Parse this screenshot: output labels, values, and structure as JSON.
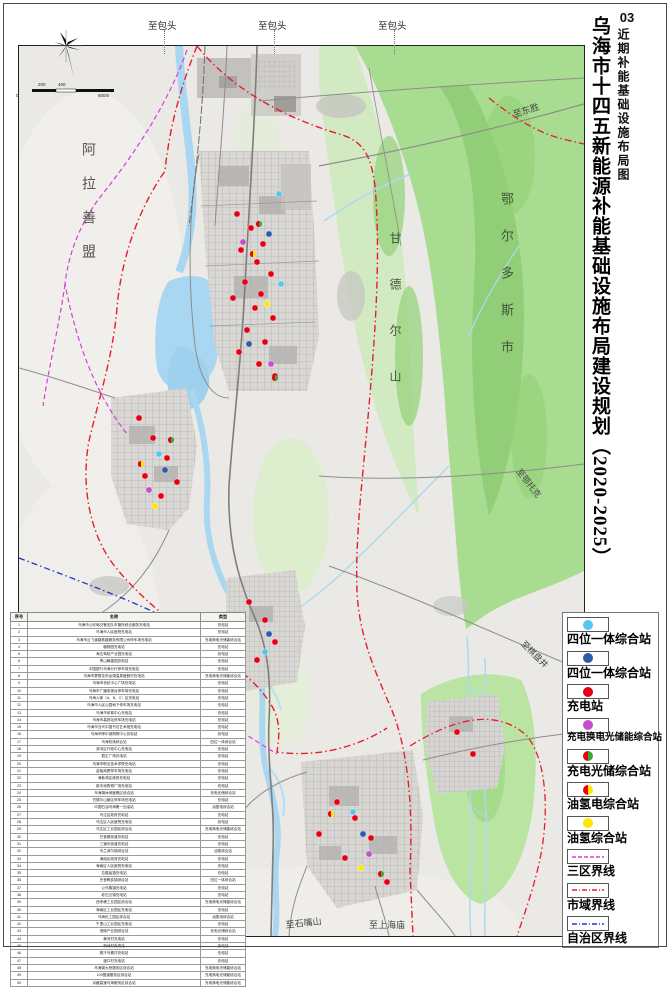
{
  "title": {
    "number": "03",
    "sheet": "近期补能基础设施布局图",
    "main": "乌海市十四五新能源补能基础设施布局建设规划（2020-2025）"
  },
  "colors": {
    "cyan": "#54c6f0",
    "blue": "#2a5caa",
    "red": "#e60012",
    "magenta": "#c44fc8",
    "green": "#3aaa35",
    "yellow": "#ffe600",
    "boundary_city": "#e81c2e",
    "boundary_zone": "#d93ed9",
    "boundary_region": "#2233cc",
    "terrain_green": "#a8dc90",
    "water": "#a9d7f2"
  },
  "legend": {
    "items": [
      {
        "symbol": "dot",
        "colors": [
          "#54c6f0"
        ],
        "label": "四位一体综合站"
      },
      {
        "symbol": "dot",
        "colors": [
          "#2a5caa"
        ],
        "label": "四位一体综合站"
      },
      {
        "symbol": "dot",
        "colors": [
          "#e60012"
        ],
        "label": "充电站"
      },
      {
        "symbol": "dot",
        "colors": [
          "#c44fc8"
        ],
        "label": "充电换电光储能综合站",
        "small": true
      },
      {
        "symbol": "split",
        "colors": [
          "#e60012",
          "#3aaa35"
        ],
        "label": "充电光储综合站"
      },
      {
        "symbol": "split",
        "colors": [
          "#e60012",
          "#ffe600"
        ],
        "label": "油氢电综合站"
      },
      {
        "symbol": "dot",
        "colors": [
          "#ffe600"
        ],
        "label": "油氢综合站"
      },
      {
        "symbol": "line",
        "colors": [
          "#d93ed9"
        ],
        "dash": "4 2",
        "label": "三区界线"
      },
      {
        "symbol": "line",
        "colors": [
          "#e81c2e"
        ],
        "dash": "5 2 1 2",
        "label": "市域界线"
      },
      {
        "symbol": "line",
        "colors": [
          "#2233cc"
        ],
        "dash": "5 2 1 2",
        "label": "自治区界线"
      }
    ]
  },
  "map": {
    "region_labels": [
      {
        "text": "阿拉善盟",
        "x": 60,
        "y": 96,
        "vertical": true,
        "size": 14,
        "ls": 20,
        "color": "#55534e"
      },
      {
        "text": "鄂尔多斯市",
        "x": 478,
        "y": 146,
        "vertical": true,
        "size": 13,
        "ls": 24,
        "color": "#41573c"
      },
      {
        "text": "甘德尔山",
        "x": 368,
        "y": 186,
        "vertical": true,
        "size": 12,
        "ls": 34,
        "color": "#41573c"
      }
    ],
    "edge_labels": [
      {
        "text": "至东胜",
        "x": 492,
        "y": 62,
        "rot": -18,
        "size": 9
      },
      {
        "text": "至鄂托克",
        "x": 504,
        "y": 420,
        "rot": 52,
        "size": 8.5
      },
      {
        "text": "至棋盘井",
        "x": 508,
        "y": 592,
        "rot": 45,
        "size": 8.5
      },
      {
        "text": "至石嘴山",
        "x": 266,
        "y": 872,
        "rot": -6,
        "size": 9
      },
      {
        "text": "至上海庙",
        "x": 350,
        "y": 872,
        "rot": 0,
        "size": 9
      }
    ],
    "top_labels": [
      {
        "text": "至包头",
        "x": 148
      },
      {
        "text": "至包头",
        "x": 258
      },
      {
        "text": "至包头",
        "x": 378
      }
    ],
    "scale_ticks": [
      {
        "t": "200",
        "x": 38,
        "y": 0
      },
      {
        "t": "400",
        "x": 58,
        "y": 0
      },
      {
        "t": "0",
        "x": 16,
        "y": 11
      },
      {
        "t": "800m",
        "x": 98,
        "y": 11
      }
    ]
  },
  "station_types": {
    "cyan4in1": {
      "colors": [
        "#54c6f0"
      ]
    },
    "blue4in1": {
      "colors": [
        "#2a5caa"
      ]
    },
    "charge": {
      "colors": [
        "#e60012"
      ]
    },
    "chargeswap": {
      "colors": [
        "#c44fc8"
      ]
    },
    "chargepv": {
      "colors": [
        "#e60012",
        "#3aaa35"
      ]
    },
    "oilh2e": {
      "colors": [
        "#e60012",
        "#ffe600"
      ]
    },
    "oilh2": {
      "colors": [
        "#ffe600"
      ]
    }
  },
  "stations": [
    {
      "t": "charge",
      "x": 218,
      "y": 168
    },
    {
      "t": "charge",
      "x": 232,
      "y": 182
    },
    {
      "t": "charge",
      "x": 244,
      "y": 198
    },
    {
      "t": "charge",
      "x": 222,
      "y": 204
    },
    {
      "t": "charge",
      "x": 238,
      "y": 216
    },
    {
      "t": "charge",
      "x": 252,
      "y": 228
    },
    {
      "t": "charge",
      "x": 226,
      "y": 236
    },
    {
      "t": "charge",
      "x": 242,
      "y": 248
    },
    {
      "t": "charge",
      "x": 214,
      "y": 252
    },
    {
      "t": "charge",
      "x": 236,
      "y": 262
    },
    {
      "t": "charge",
      "x": 254,
      "y": 272
    },
    {
      "t": "charge",
      "x": 228,
      "y": 284
    },
    {
      "t": "charge",
      "x": 246,
      "y": 296
    },
    {
      "t": "charge",
      "x": 220,
      "y": 306
    },
    {
      "t": "charge",
      "x": 240,
      "y": 318
    },
    {
      "t": "charge",
      "x": 256,
      "y": 330
    },
    {
      "t": "charge",
      "x": 120,
      "y": 372
    },
    {
      "t": "charge",
      "x": 134,
      "y": 392
    },
    {
      "t": "charge",
      "x": 148,
      "y": 412
    },
    {
      "t": "charge",
      "x": 126,
      "y": 430
    },
    {
      "t": "charge",
      "x": 142,
      "y": 450
    },
    {
      "t": "charge",
      "x": 158,
      "y": 436
    },
    {
      "t": "charge",
      "x": 230,
      "y": 556
    },
    {
      "t": "charge",
      "x": 246,
      "y": 574
    },
    {
      "t": "charge",
      "x": 256,
      "y": 596
    },
    {
      "t": "charge",
      "x": 238,
      "y": 614
    },
    {
      "t": "charge",
      "x": 318,
      "y": 756
    },
    {
      "t": "charge",
      "x": 336,
      "y": 772
    },
    {
      "t": "charge",
      "x": 352,
      "y": 792
    },
    {
      "t": "charge",
      "x": 326,
      "y": 812
    },
    {
      "t": "charge",
      "x": 300,
      "y": 788
    },
    {
      "t": "charge",
      "x": 368,
      "y": 836
    },
    {
      "t": "charge",
      "x": 438,
      "y": 686
    },
    {
      "t": "charge",
      "x": 454,
      "y": 708
    },
    {
      "t": "blue4in1",
      "x": 250,
      "y": 188
    },
    {
      "t": "blue4in1",
      "x": 230,
      "y": 298
    },
    {
      "t": "blue4in1",
      "x": 146,
      "y": 424
    },
    {
      "t": "blue4in1",
      "x": 250,
      "y": 588
    },
    {
      "t": "blue4in1",
      "x": 344,
      "y": 788
    },
    {
      "t": "cyan4in1",
      "x": 262,
      "y": 238
    },
    {
      "t": "cyan4in1",
      "x": 140,
      "y": 408
    },
    {
      "t": "cyan4in1",
      "x": 334,
      "y": 766
    },
    {
      "t": "cyan4in1",
      "x": 246,
      "y": 606
    },
    {
      "t": "cyan4in1",
      "x": 260,
      "y": 148
    },
    {
      "t": "chargeswap",
      "x": 224,
      "y": 196
    },
    {
      "t": "chargeswap",
      "x": 252,
      "y": 318
    },
    {
      "t": "chargeswap",
      "x": 130,
      "y": 444
    },
    {
      "t": "chargeswap",
      "x": 350,
      "y": 808
    },
    {
      "t": "chargepv",
      "x": 240,
      "y": 178
    },
    {
      "t": "chargepv",
      "x": 256,
      "y": 332
    },
    {
      "t": "chargepv",
      "x": 152,
      "y": 394
    },
    {
      "t": "chargepv",
      "x": 362,
      "y": 828
    },
    {
      "t": "oilh2e",
      "x": 234,
      "y": 208
    },
    {
      "t": "oilh2e",
      "x": 122,
      "y": 418
    },
    {
      "t": "oilh2e",
      "x": 312,
      "y": 768
    },
    {
      "t": "oilh2",
      "x": 248,
      "y": 258
    },
    {
      "t": "oilh2",
      "x": 136,
      "y": 460
    },
    {
      "t": "oilh2",
      "x": 342,
      "y": 822
    }
  ],
  "table": {
    "headers": [
      "序号",
      "名称",
      "类型"
    ],
    "col_widths": [
      16,
      172,
      44
    ],
    "rows": [
      [
        "1",
        "乌海市公安局交警支队车管所综合服务充电站",
        "充电站"
      ],
      [
        "2",
        "乌海市人民医院充电站",
        "充电站"
      ],
      [
        "3",
        "乌海市云飞道路救援服务有限公司停车场充电站",
        "充电换电光储能综合站"
      ],
      [
        "4",
        "植物园充电站",
        "充电站"
      ],
      [
        "5",
        "海达驾校产业园充电站",
        "充电站"
      ],
      [
        "6",
        "青山翰墨园充电站",
        "充电站"
      ],
      [
        "7",
        "中国银行乌海分行停车场充电站",
        "充电站"
      ],
      [
        "8",
        "乌海市蒙根花布龙湖温泉度假村充电站",
        "充电换电光储能综合站"
      ],
      [
        "9",
        "乌海市世纪中心广场充电站",
        "充电站"
      ],
      [
        "10",
        "乌海市广播电视台停车场充电站",
        "充电站"
      ],
      [
        "11",
        "乌海人家（A、B、C）区充电站",
        "充电站"
      ],
      [
        "12",
        "乌海市人民公园地下停车场充电站",
        "充电站"
      ],
      [
        "13",
        "乌海市体育中心充电站",
        "充电站"
      ],
      [
        "14",
        "乌海市高铁站停车场充电站",
        "充电站"
      ],
      [
        "15",
        "乌海市当代中国书法艺术馆充电站",
        "充电站"
      ],
      [
        "16",
        "乌海市摩尔城购物中心充电站",
        "充电站"
      ],
      [
        "17",
        "乌海机场综合站",
        "四位一体综合站"
      ],
      [
        "18",
        "滨河区行政中心充电站",
        "充电站"
      ],
      [
        "19",
        "君正广场充电站",
        "充电站"
      ],
      [
        "20",
        "乌海市职业技术学院充电站",
        "充电站"
      ],
      [
        "21",
        "金裕商厦停车场充电站",
        "充电站"
      ],
      [
        "22",
        "海勃湾区政府充电站",
        "充电站"
      ],
      [
        "23",
        "新天地购物广场充电站",
        "充电站"
      ],
      [
        "24",
        "乌海湖休闲度假区综合站",
        "充电光储综合站"
      ],
      [
        "25",
        "甘德尔山景区停车场充电站",
        "充电站"
      ],
      [
        "26",
        "中国石油乌海第一加油站",
        "油氢电综合站"
      ],
      [
        "27",
        "乌达区政府充电站",
        "充电站"
      ],
      [
        "28",
        "乌达区人民医院充电站",
        "充电站"
      ],
      [
        "29",
        "乌达区工业园区综合站",
        "充电换电光储能综合站"
      ],
      [
        "30",
        "巴音赛街道充电站",
        "充电站"
      ],
      [
        "31",
        "三道坎街道充电站",
        "充电站"
      ],
      [
        "32",
        "乌兰淖尔镇综合站",
        "油氢综合站"
      ],
      [
        "33",
        "海南区政府充电站",
        "充电站"
      ],
      [
        "34",
        "海南区人民医院充电站",
        "充电站"
      ],
      [
        "35",
        "拉僧庙镇充电站",
        "充电站"
      ],
      [
        "36",
        "巴音陶亥镇综合站",
        "四位一体综合站"
      ],
      [
        "37",
        "公乌素镇充电站",
        "充电站"
      ],
      [
        "38",
        "老石旦镇充电站",
        "充电站"
      ],
      [
        "39",
        "西来峰工业园区综合站",
        "充电换电光储能综合站"
      ],
      [
        "40",
        "海南区工业园区充电站",
        "充电站"
      ],
      [
        "41",
        "乌海化工园区综合站",
        "油氢电综合站"
      ],
      [
        "42",
        "千里山工业园区充电站",
        "充电站"
      ],
      [
        "43",
        "低碳产业园综合站",
        "充电光储综合站"
      ],
      [
        "44",
        "黄河村充电站",
        "充电站"
      ],
      [
        "45",
        "新地村充电站",
        "充电站"
      ],
      [
        "46",
        "赛汗乌素村充电站",
        "充电站"
      ],
      [
        "47",
        "渡口村充电站",
        "充电站"
      ],
      [
        "48",
        "乌海湖大桥服务区综合站",
        "充电换电光储能综合站"
      ],
      [
        "49",
        "109国道服务区综合站",
        "充电换电光储能综合站"
      ],
      [
        "50",
        "京藏高速乌海服务区综合站",
        "充电换电光储能综合站"
      ]
    ]
  }
}
